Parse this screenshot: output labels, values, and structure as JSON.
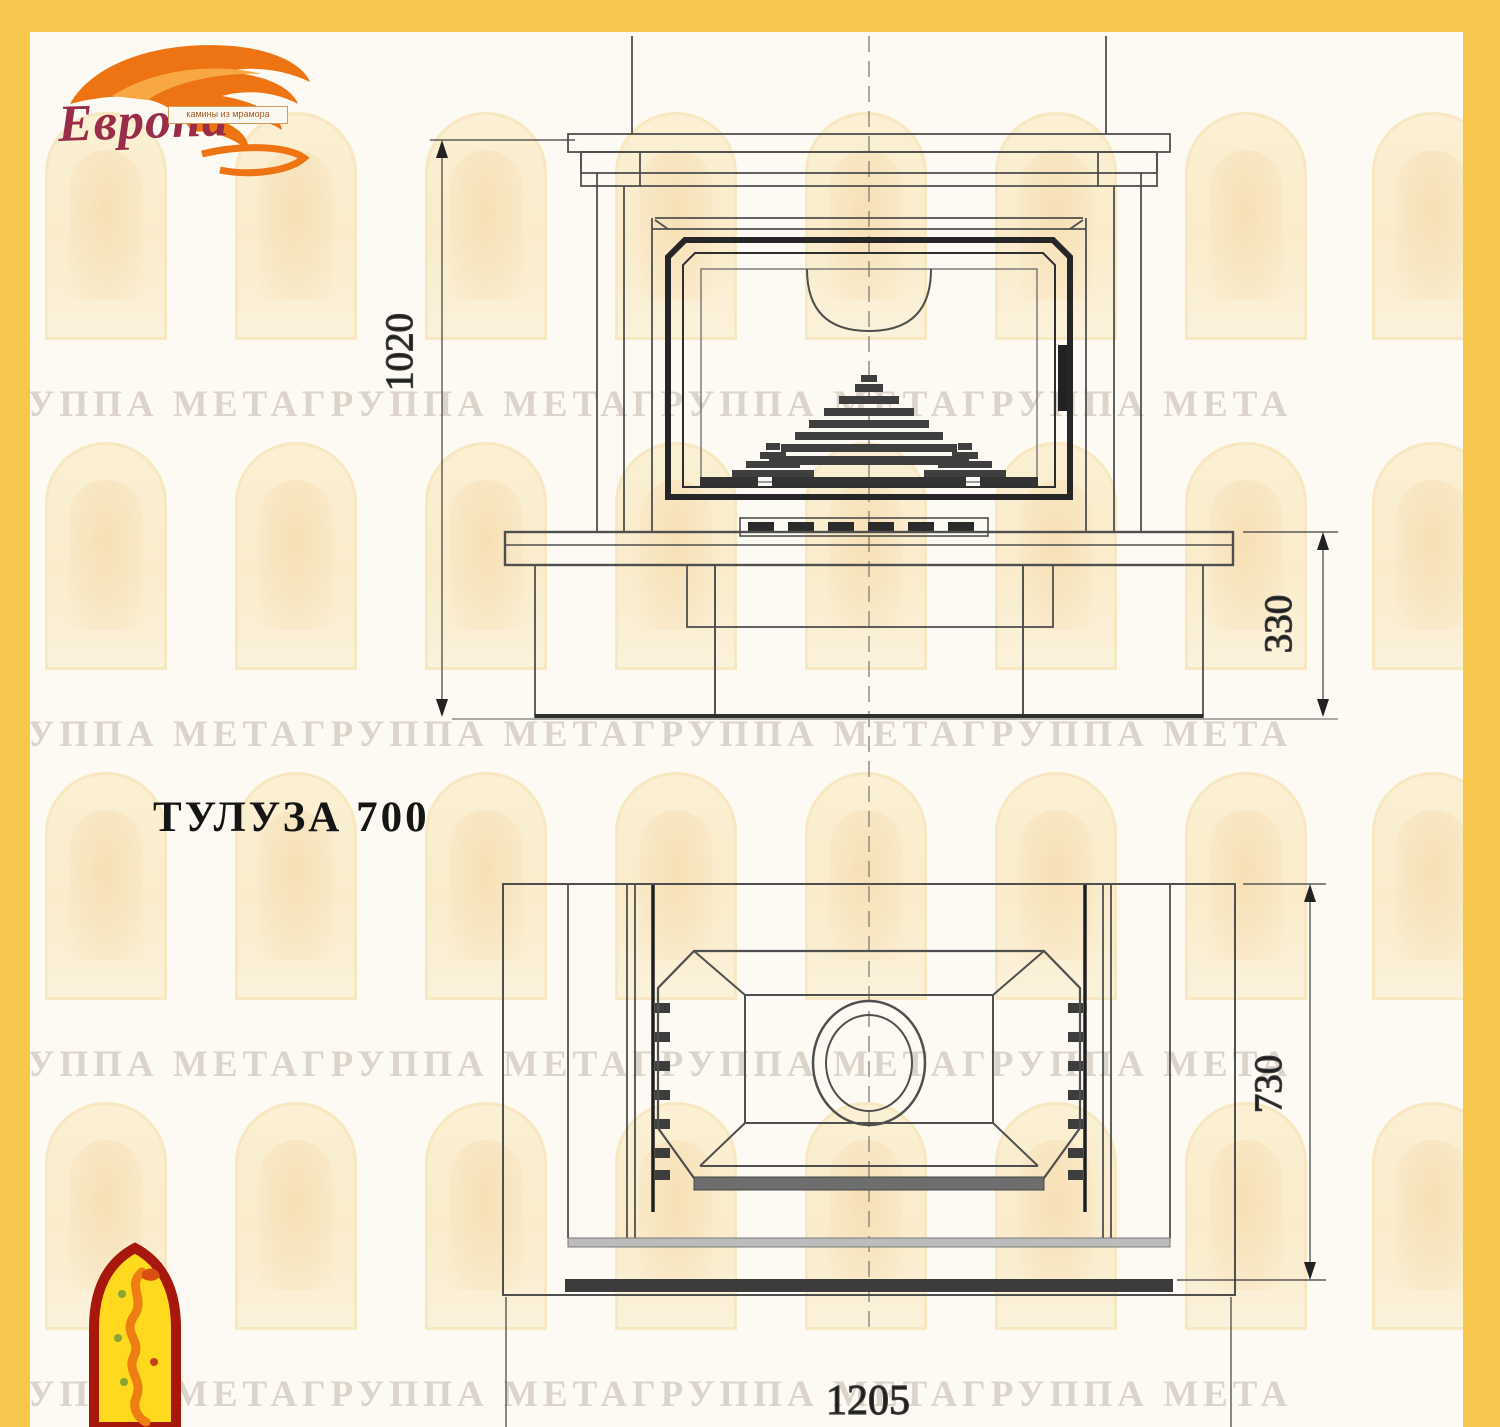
{
  "logo": {
    "name": "Европа",
    "tagline": "камины из мрамора",
    "flame_color": "#ee7312",
    "text_color": "#992c48"
  },
  "watermark": {
    "text": "ГРУППА МЕТАГРУППА МЕТАГРУППА МЕТАГРУППА МЕТА",
    "color": "#ad988e"
  },
  "drawing": {
    "title": "ТУЛУЗА 700",
    "front_view": {
      "label": "front-elevation",
      "dim_total_height": "1020",
      "dim_base_height": "330"
    },
    "plan_view": {
      "label": "top-plan-view",
      "dim_depth": "730",
      "dim_width": "1205"
    }
  },
  "frame_color": "#f5c84d"
}
